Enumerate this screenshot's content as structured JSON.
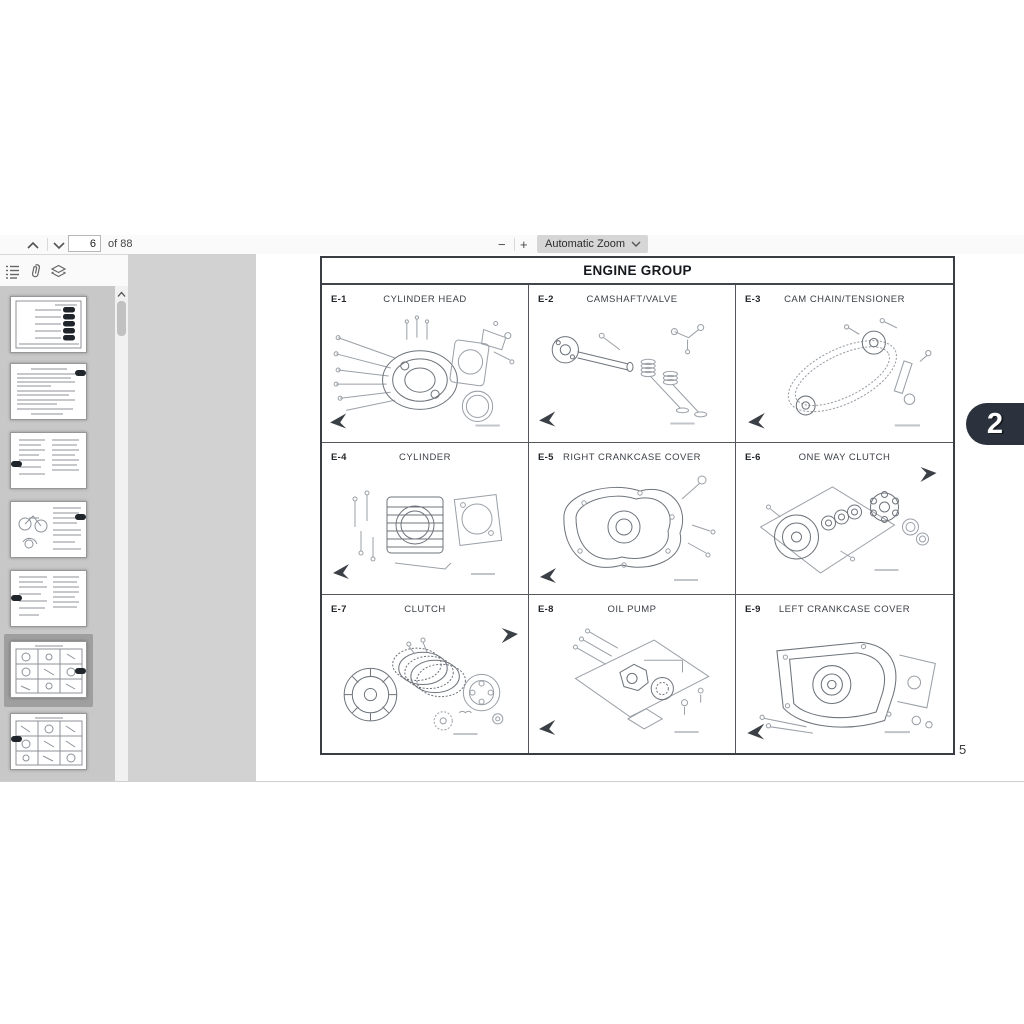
{
  "toolbar": {
    "previous_page_icon": "chevron-up",
    "next_page_icon": "chevron-down",
    "page_input_value": "6",
    "page_count_label": "of 88",
    "zoom_out_label": "−",
    "zoom_in_label": "+",
    "zoom_select_value": "Automatic Zoom"
  },
  "sidebar": {
    "outline_icon": "document-outline",
    "attachments_icon": "paperclip",
    "layers_icon": "layers",
    "thumbnail_count": 7,
    "selected_thumbnail_index": 6
  },
  "page": {
    "title": "ENGINE GROUP",
    "page_number_label": "5",
    "cells": [
      {
        "code": "E-1",
        "title": "CYLINDER HEAD"
      },
      {
        "code": "E-2",
        "title": "CAMSHAFT/VALVE"
      },
      {
        "code": "E-3",
        "title": "CAM CHAIN/TENSIONER"
      },
      {
        "code": "E-4",
        "title": "CYLINDER"
      },
      {
        "code": "E-5",
        "title": "RIGHT CRANKCASE COVER"
      },
      {
        "code": "E-6",
        "title": "ONE WAY CLUTCH"
      },
      {
        "code": "E-7",
        "title": "CLUTCH"
      },
      {
        "code": "E-8",
        "title": "OIL PUMP"
      },
      {
        "code": "E-9",
        "title": "LEFT CRANKCASE COVER"
      }
    ]
  },
  "watermark": {
    "label": "2",
    "color": "#2b323d"
  },
  "colors": {
    "viewer_background": "#d2d2d2",
    "sidebar_background": "#c8c8c8",
    "table_border": "#3a3e44",
    "toolbar_background": "#fafafa"
  }
}
